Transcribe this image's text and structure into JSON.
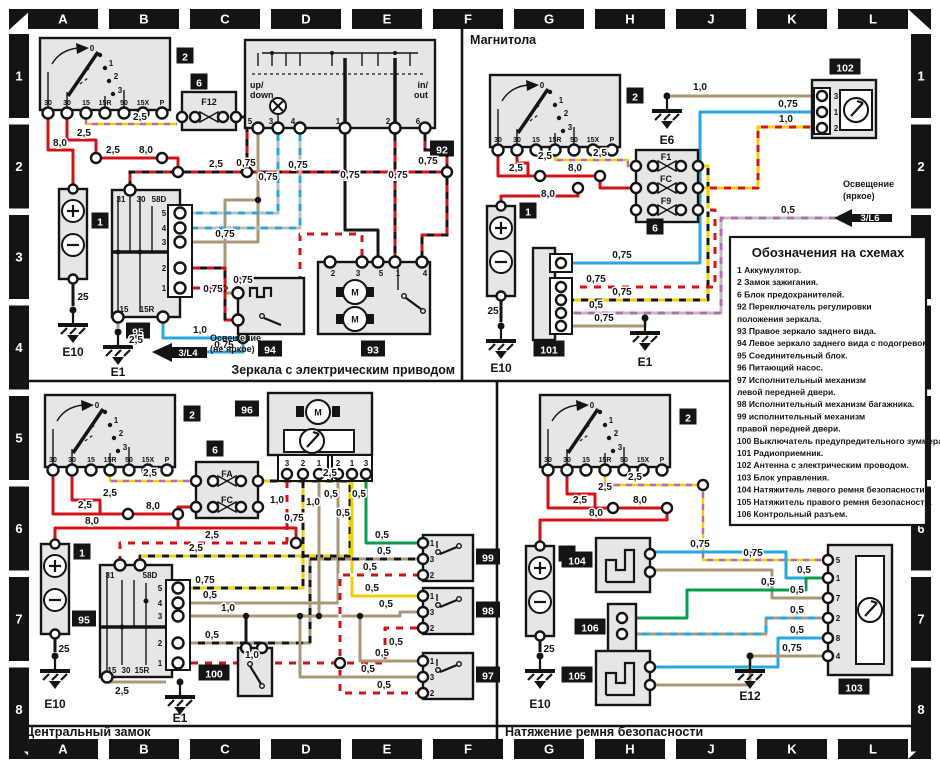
{
  "colors": {
    "frame": "#141414",
    "panel": "#e6e6e6",
    "wire_red": "#d01317",
    "wire_tan": "#ac9678",
    "wire_blue": "#2aa7de",
    "wire_green": "#089c4c",
    "wire_yellow": "#ecd000",
    "wire_purple": "#b86ab8"
  },
  "grid": {
    "cols": [
      "A",
      "B",
      "C",
      "D",
      "E",
      "F",
      "G",
      "H",
      "J",
      "K",
      "L"
    ],
    "rows": [
      "1",
      "2",
      "3",
      "4",
      "5",
      "6",
      "7",
      "8"
    ]
  },
  "legend": {
    "title": "Обозначения на схемах",
    "lines": [
      "1 Аккумулятор.",
      "2 Замок зажигания.",
      "6 Блок предохранителей.",
      "92 Переключатель регулировки",
      "положения зеркала.",
      "93 Правое зеркало заднего вида.",
      "94 Левое зеркало заднего вида с подогревом.",
      "95 Соединительный блок.",
      "96 Питающий насос.",
      "97 Исполнительный механизм",
      "левой передней двери.",
      "98 Исполнительный механизм багажника.",
      "99 исполнительный механизм",
      "правой передней двери.",
      "100 Выключатель предупредительного зуммера.",
      "101 Радиоприемник.",
      "102 Антенна с электрическим проводом.",
      "103 Блок управления.",
      "104 Натяжитель левого ремня безопасности.",
      "105 Натяжитель правого ремня безопасности.",
      "106 Контрольный разъем."
    ]
  },
  "ign": {
    "terminals": [
      "30",
      "30",
      "15",
      "15R",
      "50",
      "15X",
      "P"
    ],
    "positions": [
      "0",
      "1",
      "2",
      "3"
    ]
  },
  "act": {
    "order": [
      "1",
      "3",
      "2"
    ]
  },
  "glyphs": {
    "motor": "M"
  },
  "ann": {
    "tl": [
      {
        "k": "bx",
        "t": "2",
        "x": 185,
        "y": 59
      },
      {
        "k": "bx",
        "t": "6",
        "x": 199,
        "y": 85
      },
      {
        "k": "bx",
        "t": "92",
        "x": 442,
        "y": 152
      },
      {
        "k": "bx",
        "t": "1",
        "x": 100,
        "y": 224
      },
      {
        "k": "bx",
        "t": "95",
        "x": 138,
        "y": 334
      },
      {
        "k": "bx",
        "t": "94",
        "x": 270,
        "y": 352
      },
      {
        "k": "bx",
        "t": "93",
        "x": 373,
        "y": 352
      },
      {
        "k": "tx",
        "t": "F12",
        "x": 209,
        "y": 105,
        "a": "m"
      },
      {
        "k": "tx",
        "t": "up/",
        "x": 250,
        "y": 88
      },
      {
        "k": "tx",
        "t": "down",
        "x": 250,
        "y": 98
      },
      {
        "k": "tx",
        "t": "in/",
        "x": 428,
        "y": 88,
        "a": "e"
      },
      {
        "k": "tx",
        "t": "out",
        "x": 428,
        "y": 98,
        "a": "e"
      },
      {
        "k": "tn",
        "t": "5",
        "x": 250,
        "y": 124
      },
      {
        "k": "tn",
        "t": "3",
        "x": 271,
        "y": 124
      },
      {
        "k": "tn",
        "t": "4",
        "x": 293,
        "y": 124
      },
      {
        "k": "tn",
        "t": "1",
        "x": 338,
        "y": 124
      },
      {
        "k": "tn",
        "t": "2",
        "x": 388,
        "y": 124
      },
      {
        "k": "tn",
        "t": "6",
        "x": 418,
        "y": 124
      },
      {
        "k": "tn",
        "t": "2",
        "x": 333,
        "y": 276
      },
      {
        "k": "tn",
        "t": "3",
        "x": 358,
        "y": 276
      },
      {
        "k": "tn",
        "t": "5",
        "x": 381,
        "y": 276
      },
      {
        "k": "tn",
        "t": "1",
        "x": 398,
        "y": 276
      },
      {
        "k": "tn",
        "t": "4",
        "x": 425,
        "y": 276
      },
      {
        "k": "tn",
        "t": "31",
        "x": 121,
        "y": 202
      },
      {
        "k": "tn",
        "t": "30",
        "x": 141,
        "y": 202
      },
      {
        "k": "tn",
        "t": "58D",
        "x": 159,
        "y": 202
      },
      {
        "k": "tn",
        "t": "5",
        "x": 164,
        "y": 216,
        "a": "e"
      },
      {
        "k": "tn",
        "t": "4",
        "x": 164,
        "y": 231,
        "a": "e"
      },
      {
        "k": "tn",
        "t": "3",
        "x": 164,
        "y": 245,
        "a": "e"
      },
      {
        "k": "tn",
        "t": "2",
        "x": 164,
        "y": 271,
        "a": "e"
      },
      {
        "k": "tn",
        "t": "1",
        "x": 164,
        "y": 291,
        "a": "e"
      },
      {
        "k": "tn",
        "t": "15",
        "x": 124,
        "y": 312
      },
      {
        "k": "tn",
        "t": "15R",
        "x": 147,
        "y": 312
      },
      {
        "k": "wl",
        "t": "8,0",
        "x": 60,
        "y": 146
      },
      {
        "k": "wl",
        "t": "2,5",
        "x": 84,
        "y": 136
      },
      {
        "k": "wl",
        "t": "2,5",
        "x": 113,
        "y": 153
      },
      {
        "k": "wl",
        "t": "8,0",
        "x": 146,
        "y": 153
      },
      {
        "k": "wl",
        "t": "2,5",
        "x": 140,
        "y": 120
      },
      {
        "k": "wl",
        "t": "2,5",
        "x": 216,
        "y": 167
      },
      {
        "k": "wl",
        "t": "25",
        "x": 83,
        "y": 300
      },
      {
        "k": "wl",
        "t": "0,75",
        "x": 246,
        "y": 166
      },
      {
        "k": "wl",
        "t": "0,75",
        "x": 268,
        "y": 180
      },
      {
        "k": "wl",
        "t": "0,75",
        "x": 298,
        "y": 168
      },
      {
        "k": "wl",
        "t": "0,75",
        "x": 350,
        "y": 178
      },
      {
        "k": "wl",
        "t": "0,75",
        "x": 398,
        "y": 178
      },
      {
        "k": "wl",
        "t": "0,75",
        "x": 428,
        "y": 164
      },
      {
        "k": "wl",
        "t": "0,75",
        "x": 225,
        "y": 237
      },
      {
        "k": "wl",
        "t": "0,75",
        "x": 213,
        "y": 292
      },
      {
        "k": "wl",
        "t": "0,75",
        "x": 243,
        "y": 283
      },
      {
        "k": "wl",
        "t": "1,0",
        "x": 200,
        "y": 333
      },
      {
        "k": "wl",
        "t": "0,75",
        "x": 224,
        "y": 348
      },
      {
        "k": "wl",
        "t": "2,5",
        "x": 136,
        "y": 343
      },
      {
        "k": "gt",
        "t": "E10",
        "x": 73,
        "y": 356
      },
      {
        "k": "gt",
        "t": "E1",
        "x": 118,
        "y": 376
      },
      {
        "k": "wt",
        "t": "3/L4",
        "x": 188,
        "y": 356
      },
      {
        "k": "tx",
        "t": "Освещение",
        "x": 210,
        "y": 341
      },
      {
        "k": "tx",
        "t": "(не яркое)",
        "x": 210,
        "y": 352
      },
      {
        "k": "sec",
        "t": "Зеркала с электрическим приводом",
        "x": 455,
        "y": 374,
        "a": "e"
      }
    ],
    "tr": [
      {
        "k": "bx",
        "t": "2",
        "x": 635,
        "y": 99
      },
      {
        "k": "bx",
        "t": "6",
        "x": 655,
        "y": 230
      },
      {
        "k": "bx",
        "t": "102",
        "x": 845,
        "y": 70
      },
      {
        "k": "bx",
        "t": "1",
        "x": 528,
        "y": 214
      },
      {
        "k": "bx",
        "t": "101",
        "x": 549,
        "y": 352
      },
      {
        "k": "tx",
        "t": "F1",
        "x": 666,
        "y": 160,
        "a": "m"
      },
      {
        "k": "tx",
        "t": "FC",
        "x": 666,
        "y": 182,
        "a": "m"
      },
      {
        "k": "tx",
        "t": "F9",
        "x": 666,
        "y": 204,
        "a": "m"
      },
      {
        "k": "tn",
        "t": "3",
        "x": 836,
        "y": 99
      },
      {
        "k": "tn",
        "t": "1",
        "x": 836,
        "y": 115
      },
      {
        "k": "tn",
        "t": "2",
        "x": 836,
        "y": 131
      },
      {
        "k": "wl",
        "t": "2,5",
        "x": 516,
        "y": 171
      },
      {
        "k": "wl",
        "t": "2,5",
        "x": 545,
        "y": 159
      },
      {
        "k": "wl",
        "t": "8,0",
        "x": 575,
        "y": 171
      },
      {
        "k": "wl",
        "t": "8,0",
        "x": 548,
        "y": 197
      },
      {
        "k": "wl",
        "t": "2,5",
        "x": 600,
        "y": 156
      },
      {
        "k": "wl",
        "t": "25",
        "x": 493,
        "y": 314
      },
      {
        "k": "wl",
        "t": "1,0",
        "x": 700,
        "y": 90
      },
      {
        "k": "wl",
        "t": "0,75",
        "x": 788,
        "y": 107
      },
      {
        "k": "wl",
        "t": "1,0",
        "x": 786,
        "y": 122
      },
      {
        "k": "wl",
        "t": "0,5",
        "x": 788,
        "y": 213
      },
      {
        "k": "wl",
        "t": "0,75",
        "x": 622,
        "y": 258
      },
      {
        "k": "wl",
        "t": "0,75",
        "x": 596,
        "y": 282
      },
      {
        "k": "wl",
        "t": "0,75",
        "x": 622,
        "y": 295
      },
      {
        "k": "wl",
        "t": "0,5",
        "x": 596,
        "y": 308
      },
      {
        "k": "wl",
        "t": "0,75",
        "x": 604,
        "y": 321
      },
      {
        "k": "gt",
        "t": "E6",
        "x": 667,
        "y": 144
      },
      {
        "k": "gt",
        "t": "E10",
        "x": 501,
        "y": 372
      },
      {
        "k": "gt",
        "t": "E1",
        "x": 645,
        "y": 366
      },
      {
        "k": "wt",
        "t": "3/L6",
        "x": 870,
        "y": 221
      },
      {
        "k": "tx",
        "t": "Освещение",
        "x": 843,
        "y": 187
      },
      {
        "k": "tx",
        "t": "(яркое)",
        "x": 843,
        "y": 199
      },
      {
        "k": "sec",
        "t": "Магнитола",
        "x": 470,
        "y": 44,
        "a": "s"
      }
    ],
    "bl": [
      {
        "k": "bx",
        "t": "2",
        "x": 192,
        "y": 417
      },
      {
        "k": "bx",
        "t": "6",
        "x": 215,
        "y": 452
      },
      {
        "k": "bx",
        "t": "1",
        "x": 82,
        "y": 555
      },
      {
        "k": "bx",
        "t": "95",
        "x": 84,
        "y": 622
      },
      {
        "k": "bx",
        "t": "96",
        "x": 247,
        "y": 412
      },
      {
        "k": "bx",
        "t": "100",
        "x": 214,
        "y": 676
      },
      {
        "k": "bx",
        "t": "99",
        "x": 488,
        "y": 560
      },
      {
        "k": "bx",
        "t": "98",
        "x": 488,
        "y": 613
      },
      {
        "k": "bx",
        "t": "97",
        "x": 488,
        "y": 678
      },
      {
        "k": "tx",
        "t": "FA",
        "x": 227,
        "y": 477,
        "a": "m"
      },
      {
        "k": "tx",
        "t": "FC",
        "x": 227,
        "y": 503,
        "a": "m"
      },
      {
        "k": "tn",
        "t": "31",
        "x": 110,
        "y": 578
      },
      {
        "k": "tn",
        "t": "58D",
        "x": 150,
        "y": 578
      },
      {
        "k": "tn",
        "t": "5",
        "x": 160,
        "y": 591,
        "a": "e"
      },
      {
        "k": "tn",
        "t": "4",
        "x": 160,
        "y": 606,
        "a": "e"
      },
      {
        "k": "tn",
        "t": "3",
        "x": 160,
        "y": 619,
        "a": "e"
      },
      {
        "k": "tn",
        "t": "2",
        "x": 160,
        "y": 646,
        "a": "e"
      },
      {
        "k": "tn",
        "t": "1",
        "x": 160,
        "y": 666,
        "a": "e"
      },
      {
        "k": "tn",
        "t": "15",
        "x": 112,
        "y": 673
      },
      {
        "k": "tn",
        "t": "30",
        "x": 126,
        "y": 673
      },
      {
        "k": "tn",
        "t": "15R",
        "x": 142,
        "y": 673
      },
      {
        "k": "tn",
        "t": "3",
        "x": 287,
        "y": 466
      },
      {
        "k": "tn",
        "t": "2",
        "x": 303,
        "y": 466
      },
      {
        "k": "tn",
        "t": "1",
        "x": 319,
        "y": 466
      },
      {
        "k": "tn",
        "t": "2",
        "x": 338,
        "y": 466
      },
      {
        "k": "tn",
        "t": "1",
        "x": 352,
        "y": 466
      },
      {
        "k": "tn",
        "t": "3",
        "x": 366,
        "y": 466
      },
      {
        "k": "wl",
        "t": "2,5",
        "x": 85,
        "y": 508
      },
      {
        "k": "wl",
        "t": "2,5",
        "x": 110,
        "y": 496
      },
      {
        "k": "wl",
        "t": "8,0",
        "x": 153,
        "y": 509
      },
      {
        "k": "wl",
        "t": "8,0",
        "x": 92,
        "y": 524
      },
      {
        "k": "wl",
        "t": "2,5",
        "x": 150,
        "y": 476
      },
      {
        "k": "wl",
        "t": "2,5",
        "x": 330,
        "y": 476
      },
      {
        "k": "wl",
        "t": "2,5",
        "x": 212,
        "y": 538
      },
      {
        "k": "wl",
        "t": "2,5",
        "x": 196,
        "y": 551
      },
      {
        "k": "wl",
        "t": "25",
        "x": 64,
        "y": 652
      },
      {
        "k": "wl",
        "t": "2,5",
        "x": 122,
        "y": 694
      },
      {
        "k": "wl",
        "t": "0,75",
        "x": 205,
        "y": 583
      },
      {
        "k": "wl",
        "t": "0,5",
        "x": 210,
        "y": 598
      },
      {
        "k": "wl",
        "t": "1,0",
        "x": 228,
        "y": 611
      },
      {
        "k": "wl",
        "t": "0,5",
        "x": 212,
        "y": 638
      },
      {
        "k": "wl",
        "t": "1,0",
        "x": 252,
        "y": 658
      },
      {
        "k": "wl",
        "t": "1,0",
        "x": 277,
        "y": 503
      },
      {
        "k": "wl",
        "t": "0,75",
        "x": 294,
        "y": 521
      },
      {
        "k": "wl",
        "t": "1,0",
        "x": 313,
        "y": 505
      },
      {
        "k": "wl",
        "t": "0,5",
        "x": 331,
        "y": 497
      },
      {
        "k": "wl",
        "t": "0,5",
        "x": 343,
        "y": 516
      },
      {
        "k": "wl",
        "t": "0,5",
        "x": 359,
        "y": 497
      },
      {
        "k": "wl",
        "t": "0,5",
        "x": 382,
        "y": 538
      },
      {
        "k": "wl",
        "t": "0,5",
        "x": 384,
        "y": 554
      },
      {
        "k": "wl",
        "t": "0,5",
        "x": 370,
        "y": 570
      },
      {
        "k": "wl",
        "t": "0,5",
        "x": 372,
        "y": 591
      },
      {
        "k": "wl",
        "t": "0,5",
        "x": 386,
        "y": 607
      },
      {
        "k": "wl",
        "t": "0,5",
        "x": 396,
        "y": 645
      },
      {
        "k": "wl",
        "t": "0,5",
        "x": 382,
        "y": 656
      },
      {
        "k": "wl",
        "t": "0,5",
        "x": 368,
        "y": 672
      },
      {
        "k": "wl",
        "t": "0,5",
        "x": 384,
        "y": 688
      },
      {
        "k": "gt",
        "t": "E10",
        "x": 55,
        "y": 708
      },
      {
        "k": "gt",
        "t": "E1",
        "x": 180,
        "y": 722
      },
      {
        "k": "sec",
        "t": "Центральный замок",
        "x": 25,
        "y": 736,
        "a": "s"
      }
    ],
    "br": [
      {
        "k": "bx",
        "t": "2",
        "x": 688,
        "y": 420
      },
      {
        "k": "bx",
        "t": "1",
        "x": 567,
        "y": 557
      },
      {
        "k": "bx",
        "t": "104",
        "x": 577,
        "y": 563
      },
      {
        "k": "bx",
        "t": "106",
        "x": 590,
        "y": 630
      },
      {
        "k": "bx",
        "t": "105",
        "x": 577,
        "y": 678
      },
      {
        "k": "bx",
        "t": "103",
        "x": 854,
        "y": 690
      },
      {
        "k": "tn",
        "t": "5",
        "x": 838,
        "y": 563,
        "a": "s"
      },
      {
        "k": "tn",
        "t": "1",
        "x": 838,
        "y": 581,
        "a": "s"
      },
      {
        "k": "tn",
        "t": "7",
        "x": 838,
        "y": 601,
        "a": "s"
      },
      {
        "k": "tn",
        "t": "2",
        "x": 838,
        "y": 621,
        "a": "s"
      },
      {
        "k": "tn",
        "t": "8",
        "x": 838,
        "y": 641,
        "a": "s"
      },
      {
        "k": "tn",
        "t": "4",
        "x": 838,
        "y": 659,
        "a": "s"
      },
      {
        "k": "wl",
        "t": "2,5",
        "x": 580,
        "y": 503
      },
      {
        "k": "wl",
        "t": "2,5",
        "x": 605,
        "y": 490
      },
      {
        "k": "wl",
        "t": "8,0",
        "x": 640,
        "y": 503
      },
      {
        "k": "wl",
        "t": "8,0",
        "x": 596,
        "y": 516
      },
      {
        "k": "wl",
        "t": "2,5",
        "x": 635,
        "y": 480
      },
      {
        "k": "wl",
        "t": "0,75",
        "x": 753,
        "y": 556
      },
      {
        "k": "wl",
        "t": "25",
        "x": 549,
        "y": 652
      },
      {
        "k": "wl",
        "t": "0,75",
        "x": 700,
        "y": 547
      },
      {
        "k": "wl",
        "t": "0,5",
        "x": 804,
        "y": 573
      },
      {
        "k": "wl",
        "t": "0,5",
        "x": 768,
        "y": 585
      },
      {
        "k": "wl",
        "t": "0,5",
        "x": 797,
        "y": 593
      },
      {
        "k": "wl",
        "t": "0,5",
        "x": 797,
        "y": 613
      },
      {
        "k": "wl",
        "t": "0,5",
        "x": 797,
        "y": 633
      },
      {
        "k": "wl",
        "t": "0,75",
        "x": 792,
        "y": 651
      },
      {
        "k": "gt",
        "t": "E10",
        "x": 540,
        "y": 708
      },
      {
        "k": "gt",
        "t": "E12",
        "x": 750,
        "y": 700
      },
      {
        "k": "sec",
        "t": "Натяжение ремня безопасности",
        "x": 505,
        "y": 736,
        "a": "s"
      }
    ]
  }
}
